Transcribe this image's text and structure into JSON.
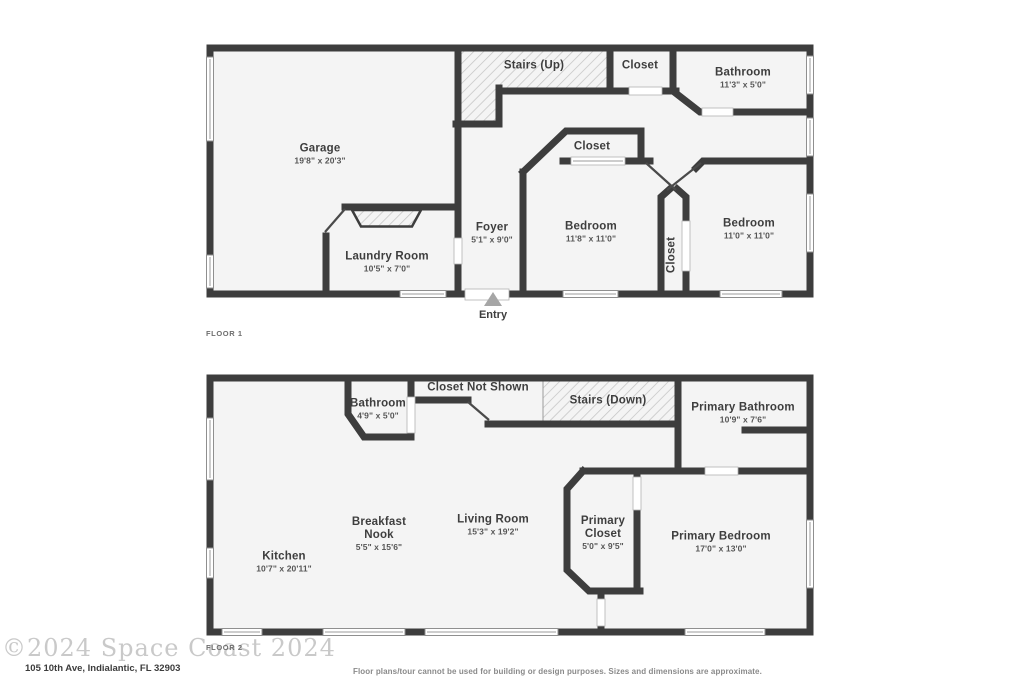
{
  "floors": [
    {
      "label": "FLOOR 1",
      "entry_label": "Entry",
      "rooms": [
        {
          "name": "Garage",
          "dims": "19'8\" x 20'3\""
        },
        {
          "name": "Stairs (Up)",
          "dims": ""
        },
        {
          "name": "Closet",
          "dims": ""
        },
        {
          "name": "Bathroom",
          "dims": "11'3\" x 5'0\""
        },
        {
          "name": "Closet",
          "dims": ""
        },
        {
          "name": "Bedroom",
          "dims": "11'8\" x 11'0\""
        },
        {
          "name": "Closet",
          "dims": ""
        },
        {
          "name": "Bedroom",
          "dims": "11'0\" x 11'0\""
        },
        {
          "name": "Foyer",
          "dims": "5'1\" x 9'0\""
        },
        {
          "name": "Laundry Room",
          "dims": "10'5\" x 7'0\""
        }
      ]
    },
    {
      "label": "FLOOR 2",
      "rooms": [
        {
          "name": "Bathroom",
          "dims": "4'9\" x 5'0\""
        },
        {
          "name": "Closet Not Shown",
          "dims": ""
        },
        {
          "name": "Stairs (Down)",
          "dims": ""
        },
        {
          "name": "Primary Bathroom",
          "dims": "10'9\" x 7'6\""
        },
        {
          "name": "Kitchen",
          "dims": "10'7\" x 20'11\""
        },
        {
          "name": "Breakfast Nook",
          "dims": "5'5\" x 15'6\""
        },
        {
          "name": "Living Room",
          "dims": "15'3\" x 19'2\""
        },
        {
          "name": "Primary Closet",
          "dims": "5'0\" x 9'5\""
        },
        {
          "name": "Primary Bedroom",
          "dims": "17'0\" x 13'0\""
        }
      ]
    }
  ],
  "footer": {
    "watermark": "©2024 Space Coast 2024",
    "address": "105 10th Ave, Indialantic, FL 32903",
    "disclaimer": "Floor plans/tour cannot be used for building or design purposes. Sizes and dimensions are approximate."
  },
  "colors": {
    "wall": "#3d3d3d",
    "room_fill": "#f4f4f4",
    "hatch_line": "#c4c4c4",
    "entry_arrow": "#a6a6a6"
  }
}
